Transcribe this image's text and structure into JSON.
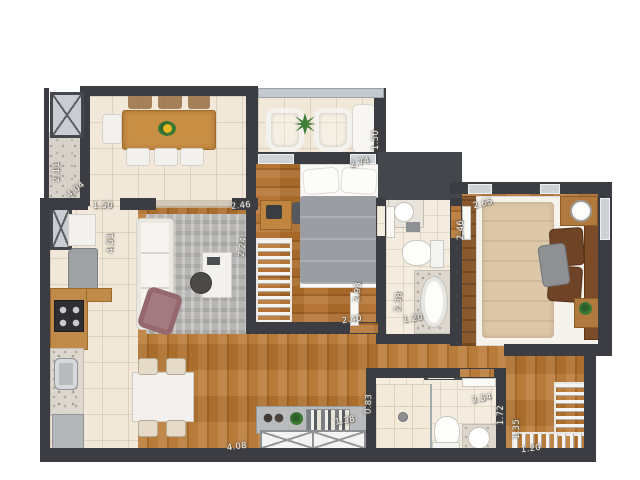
{
  "colors": {
    "wall": "#3b3d42",
    "wood_floor": "#b5742e",
    "wood_dark": "#8a5a2e",
    "tile_floor": "#f1e8d9",
    "marble": "#ddd7cd",
    "rug": "#b7b6b4",
    "bed_gray": "#9b9da4",
    "bed_beige": "#dcc7a8",
    "armchair_mauve": "#a37a80",
    "plant_green": "#3f7d36"
  },
  "icons": {
    "elevator": "elevator-x-icon",
    "duct": "duct-x-icon",
    "plant": "plant-star-icon"
  },
  "labels": [
    {
      "id": "hall-width",
      "text": "2.11"
    },
    {
      "id": "hall-length",
      "text": "4.04"
    },
    {
      "id": "kitchen-entry",
      "text": "1.50"
    },
    {
      "id": "kitchen-length",
      "text": "4.51"
    },
    {
      "id": "bedroom1-width",
      "text": "2.46"
    },
    {
      "id": "bedroom1-entry",
      "text": "2.24"
    },
    {
      "id": "balcony-depth",
      "text": "1.50"
    },
    {
      "id": "balcony-width",
      "text": "2.74"
    },
    {
      "id": "bedroom1-length",
      "text": "2.93"
    },
    {
      "id": "bedroom1-width-b",
      "text": "2.40"
    },
    {
      "id": "bathroom1-length",
      "text": "2.38"
    },
    {
      "id": "bathroom1-width",
      "text": "1.20"
    },
    {
      "id": "master-width",
      "text": "2.65"
    },
    {
      "id": "master-depth",
      "text": "2.46"
    },
    {
      "id": "living-width",
      "text": "4.08"
    },
    {
      "id": "sideboard-depth",
      "text": "0.83"
    },
    {
      "id": "sideboard-width",
      "text": "1.38"
    },
    {
      "id": "bathroom2-width",
      "text": "2.54"
    },
    {
      "id": "bathroom2-depth",
      "text": "1.72"
    },
    {
      "id": "closet-depth",
      "text": "1.35"
    },
    {
      "id": "closet-width",
      "text": "1.20"
    }
  ]
}
